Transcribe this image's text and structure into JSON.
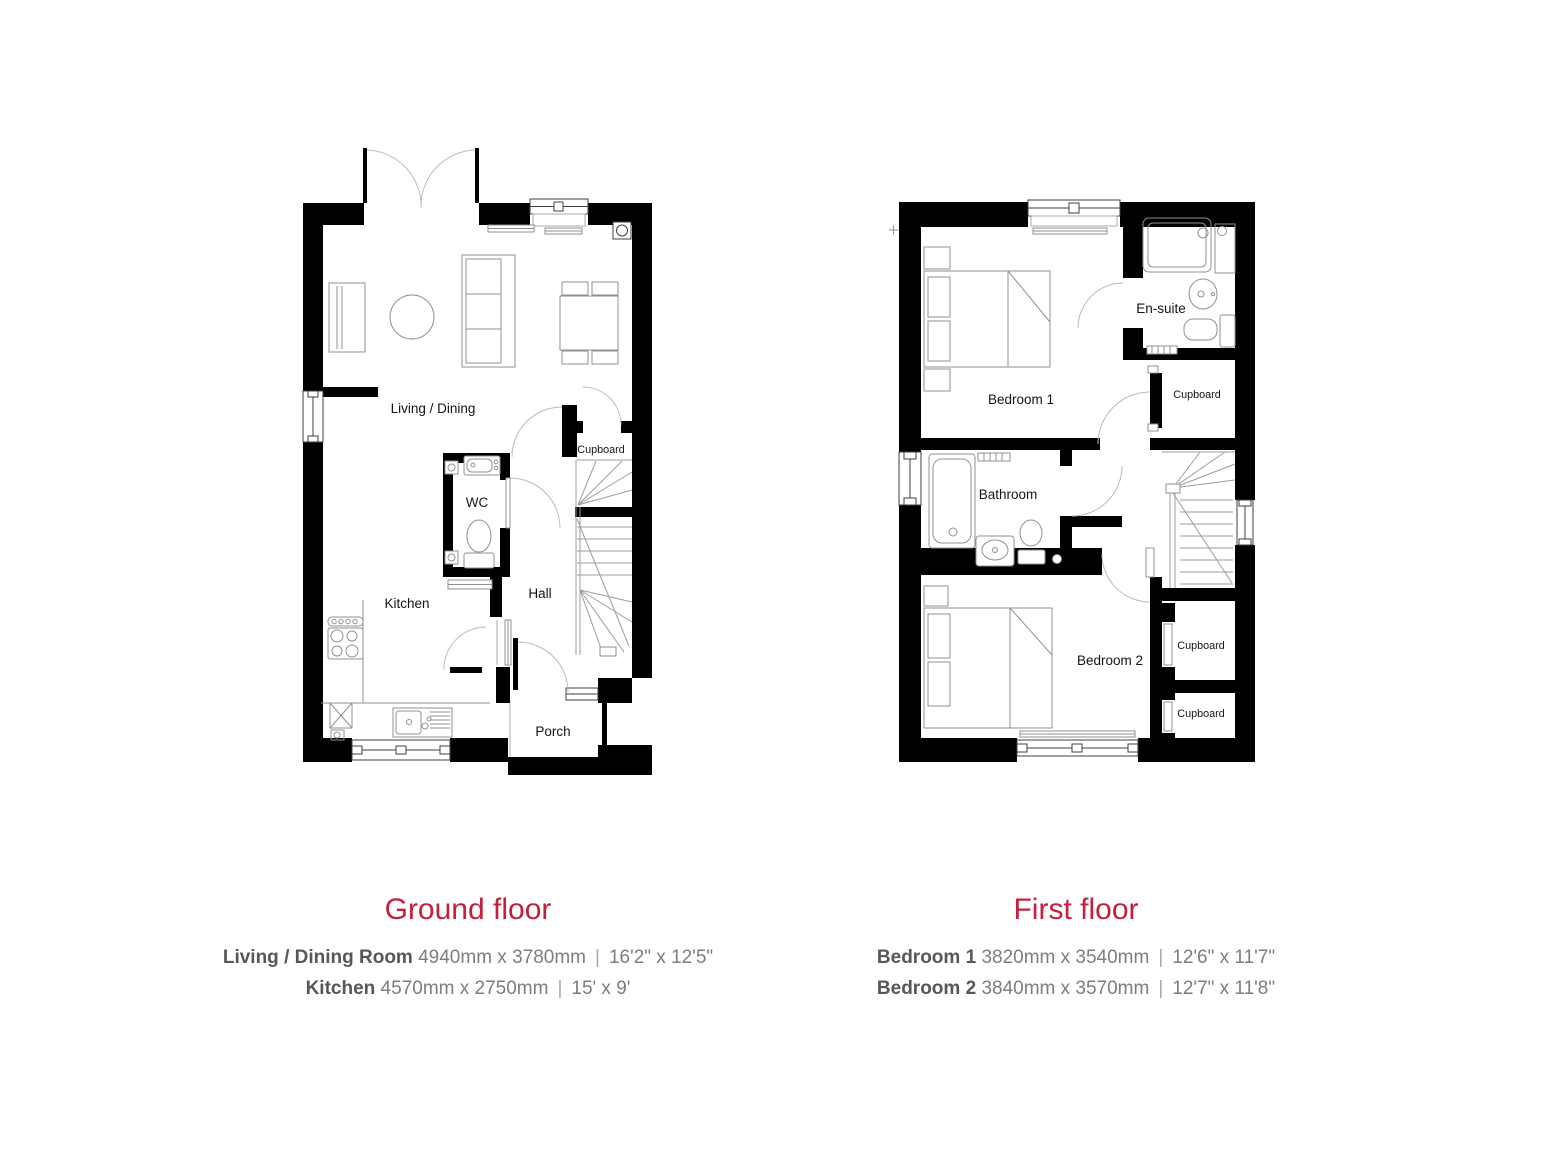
{
  "page": {
    "background": "#ffffff"
  },
  "colors": {
    "accent_red": "#c41f3c",
    "wall_black": "#000000",
    "room_label": "#141414",
    "room_name_gray": "#56575a",
    "dimension_gray": "#7b7d80",
    "separator_gray": "#a7a9ac",
    "furniture_gray": "#8f9193",
    "door_arc_gray": "#b9bbbd"
  },
  "separators": {
    "pipe": "|"
  },
  "ground_floor": {
    "title": "Ground floor",
    "labels": {
      "living_dining": "Living / Dining",
      "cupboard": "Cupboard",
      "wc": "WC",
      "kitchen": "Kitchen",
      "hall": "Hall",
      "porch": "Porch"
    },
    "dimensions": [
      {
        "room": "Living / Dining Room",
        "metric": "4940mm x 3780mm",
        "imperial": "16'2\" x 12'5\""
      },
      {
        "room": "Kitchen",
        "metric": "4570mm x 2750mm",
        "imperial": "15' x 9'"
      }
    ]
  },
  "first_floor": {
    "title": "First floor",
    "labels": {
      "bedroom1": "Bedroom 1",
      "ensuite": "En-suite",
      "cupboard_landing": "Cupboard",
      "bathroom": "Bathroom",
      "bedroom2": "Bedroom 2",
      "cupboard_mid": "Cupboard",
      "cupboard_bottom": "Cupboard"
    },
    "dimensions": [
      {
        "room": "Bedroom 1",
        "metric": "3820mm x 3540mm",
        "imperial": "12'6\" x 11'7\""
      },
      {
        "room": "Bedroom 2",
        "metric": "3840mm x 3570mm",
        "imperial": "12'7\" x 11'8\""
      }
    ]
  }
}
